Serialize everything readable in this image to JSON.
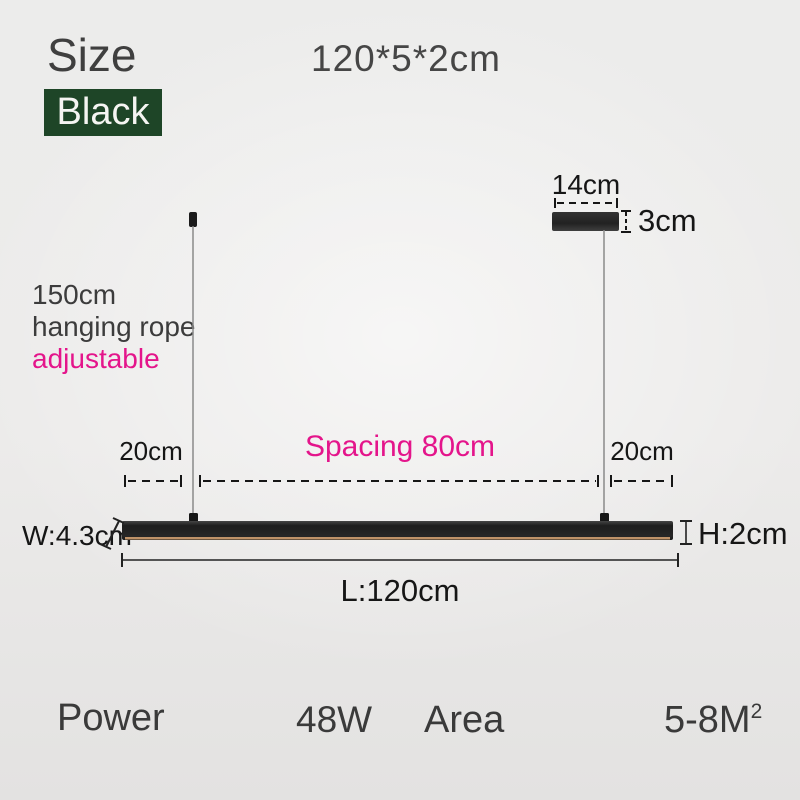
{
  "header": {
    "size_label": "Size",
    "dimensions": "120*5*2cm",
    "color_option": "Black"
  },
  "rope_note": {
    "line1": "150cm",
    "line2": "hanging rope",
    "line3": "adjustable"
  },
  "diagram": {
    "canopy_width": "14cm",
    "canopy_height": "3cm",
    "left_spacing": "20cm",
    "center_spacing": "Spacing 80cm",
    "right_spacing": "20cm",
    "bar_width": "W:4.3cm",
    "bar_height": "H:2cm",
    "bar_length": "L:120cm"
  },
  "specs": {
    "power_label": "Power",
    "power_value": "48W",
    "area_label": "Area",
    "area_value": "5-8M",
    "area_value_sup": "2"
  },
  "colors": {
    "accent_pink": "#e4158b",
    "chip_green": "#1e4527",
    "lamp_black": "#1d1d1d",
    "lamp_glow_line": "#bf9268",
    "measure_ink": "#161616"
  }
}
